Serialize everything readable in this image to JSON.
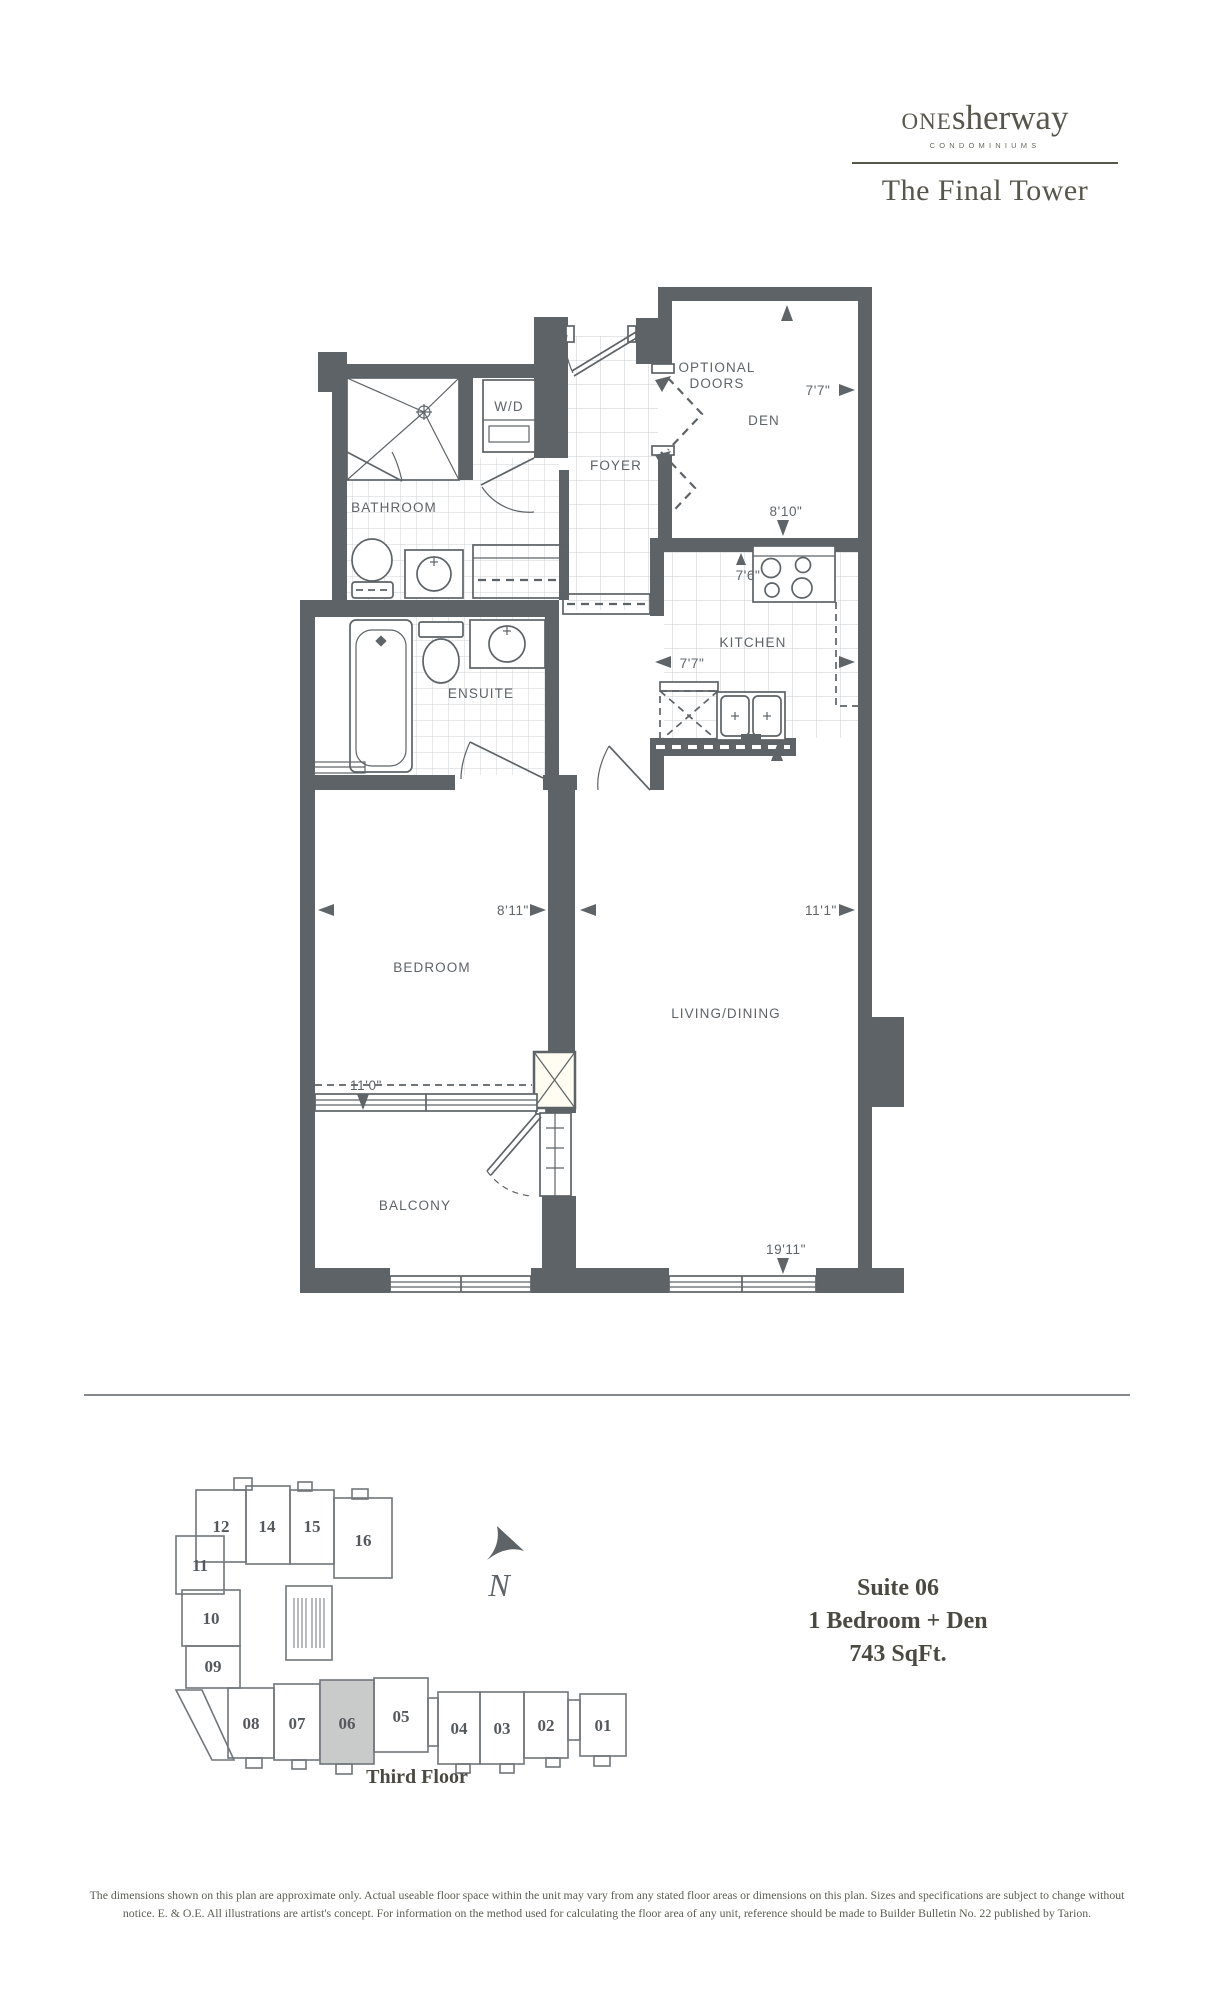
{
  "brand": {
    "one": "ONE",
    "sherway": "sherway",
    "sub": "CONDOMINIUMS",
    "tagline": "The Final Tower"
  },
  "plan": {
    "rooms": {
      "bathroom": "BATHROOM",
      "wd": "W/D",
      "foyer": "FOYER",
      "optional1": "OPTIONAL",
      "optional2": "DOORS",
      "den": "DEN",
      "kitchen": "KITCHEN",
      "ensuite": "ENSUITE",
      "bedroom": "BEDROOM",
      "living": "LIVING/DINING",
      "balcony": "BALCONY"
    },
    "dims": {
      "den_width": "7'7\"",
      "den_depth": "8'10\"",
      "kitchen_depth": "7'6\"",
      "kitchen_width": "7'7\"",
      "bedroom_width": "8'11\"",
      "living_width": "11'1\"",
      "bedroom_depth": "11'0\"",
      "living_depth": "19'11\""
    }
  },
  "keyplan": {
    "north": "N",
    "floor": "Third Floor",
    "highlighted": "06",
    "units": [
      {
        "label": "12"
      },
      {
        "label": "14"
      },
      {
        "label": "15"
      },
      {
        "label": "16"
      },
      {
        "label": "11"
      },
      {
        "label": "10"
      },
      {
        "label": "09"
      },
      {
        "label": "08"
      },
      {
        "label": "07"
      },
      {
        "label": "06"
      },
      {
        "label": "05"
      },
      {
        "label": "04"
      },
      {
        "label": "03"
      },
      {
        "label": "02"
      },
      {
        "label": "01"
      }
    ]
  },
  "suite": {
    "name": "Suite 06",
    "type": "1 Bedroom + Den",
    "area": "743 SqFt."
  },
  "disclaimer": "The dimensions shown on this plan are approximate only. Actual useable floor space within the unit may vary from any stated floor areas or dimensions on this plan. Sizes and specifications are subject to change without notice. E. & O.E. All illustrations are artist's concept. For information on the method used for calculating the floor area of any unit, reference should be made to Builder Bulletin No. 22 published by Tarion.",
  "colors": {
    "wall": "#5d6367",
    "keyplan_line": "#71767a",
    "brand": "#57564c",
    "highlight": "#c9cbca"
  }
}
